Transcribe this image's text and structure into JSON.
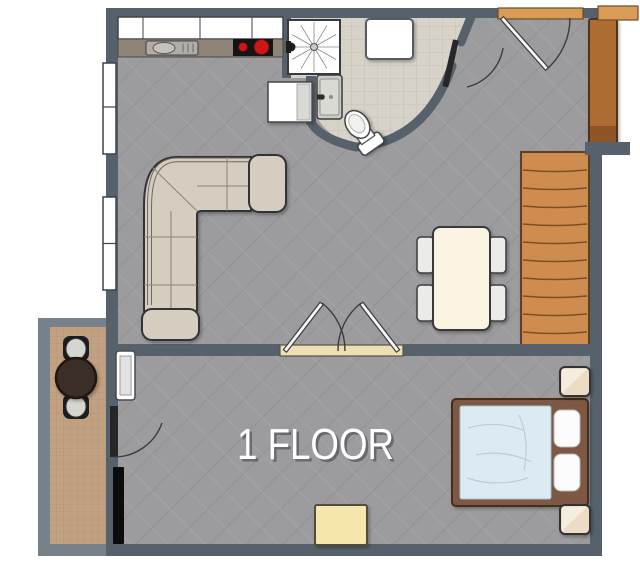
{
  "floor_label": "1 FLOOR",
  "colors": {
    "background": "#ffffff",
    "wall": "#57616b",
    "wall_light": "#76818a",
    "floor_main": "#9c9c9e",
    "floor_bathroom": "#d7d3c8",
    "floor_balcony": "#c2a183",
    "stairs": "#cf8c4f",
    "wardrobe": "#ad6d33",
    "entry_threshold": "#d99c56",
    "door_threshold": "#eee0b4",
    "sofa": "#d5cdc0",
    "dining_table": "#fbf4e2",
    "chair": "#ebebe9",
    "bed_frame": "#7b5844",
    "bed_duvet": "#dcebf3",
    "pillow": "#fcfcfc",
    "nightstand": "#ecdcc6",
    "ottoman": "#f4e6ad",
    "counter": "#8d8377",
    "cooktop": "#141414",
    "burner": "#cf1616",
    "balcony_table": "#3a2d25",
    "fixture_white": "#ffffff",
    "line": "#3a3a3e",
    "label_text": "#ffffff"
  },
  "items": [
    "kitchen-upper-cabinets",
    "kitchen-counter",
    "kitchen-sink",
    "cooktop",
    "fridge-cabinet",
    "shower",
    "washing-machine",
    "bathroom-sink",
    "toilet",
    "bathroom-door",
    "entry-threshold",
    "entry-door",
    "corner-landing",
    "wardrobe",
    "stairs",
    "dining-table",
    "dining-chairs",
    "corner-sofa",
    "double-door",
    "left-windows",
    "radiator",
    "balcony-door",
    "wall-tv",
    "bed",
    "duvet",
    "pillows",
    "nightstands",
    "ottoman",
    "balcony-table",
    "balcony-chairs"
  ]
}
